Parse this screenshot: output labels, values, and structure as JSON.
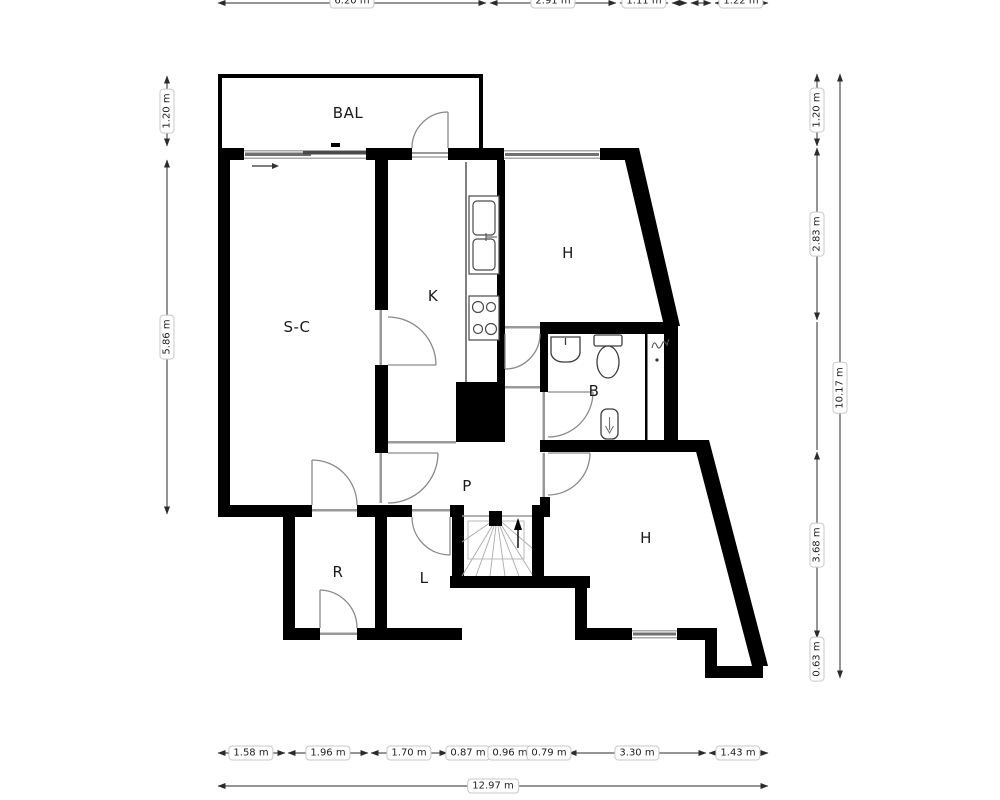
{
  "rooms": {
    "balcony": "BAL",
    "living": "S-C",
    "kitchen": "K",
    "hall_upper": "H",
    "bath": "B",
    "passage": "P",
    "room_r": "R",
    "room_l": "L",
    "hall_lower": "H"
  },
  "dimensions": {
    "top": [
      "6.20 m",
      "2.91 m",
      "1.11 m",
      "1.22 m"
    ],
    "left": [
      "1.20 m",
      "5.86 m"
    ],
    "right": [
      "1.20 m",
      "2.83 m",
      "3.68 m",
      "0.63 m"
    ],
    "right_total": "10.17 m",
    "bottom": [
      "1.58 m",
      "1.96 m",
      "1.70 m",
      "0.87 m",
      "0.96 m",
      "0.79 m",
      "3.30 m",
      "1.43 m"
    ],
    "bottom_total": "12.97 m"
  },
  "colors": {
    "wall": "#000000",
    "window": "#787878",
    "dimension_line": "#2b2b2b",
    "door_arc": "#8a8a8a"
  }
}
